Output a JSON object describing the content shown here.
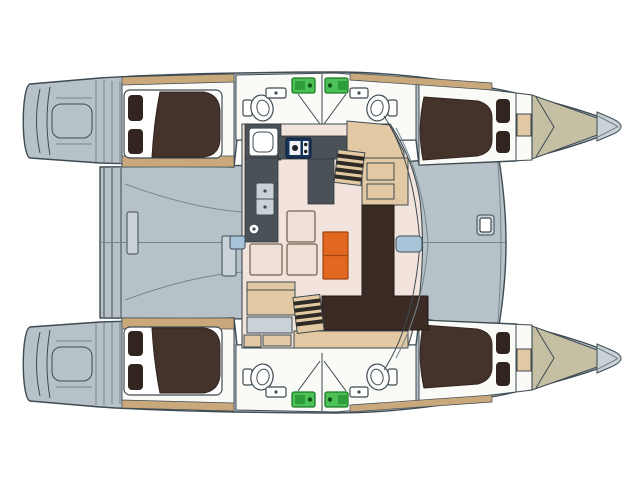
{
  "canvas": {
    "width": 640,
    "height": 480,
    "background": "#ffffff"
  },
  "diagram": {
    "type": "deck-plan",
    "subject": "catamaran interior layout, top view, bows pointing right",
    "rooms": [
      "port aft cabin",
      "port forward cabin",
      "starboard aft cabin",
      "starboard forward cabin",
      "port heads x2",
      "starboard heads x2",
      "salon with galley and chart table",
      "aft cockpit deck",
      "foredeck",
      "forepeak lockers",
      "swim platforms",
      "bow tips"
    ],
    "furniture_icons": [
      "double-berth-with-pillows x4",
      "toilet x4",
      "washbasin x4",
      "galley-stove",
      "galley-sink",
      "double-sink-unit",
      "l-shaped-sofa",
      "orange-table",
      "chart-table-with-seat",
      "hull-staircase x2",
      "deck-locker x2",
      "foredeck-hatch",
      "escape-hatch-green x4",
      "floor-panel x3",
      "door-cushion-blue x2"
    ]
  },
  "colors": {
    "background": "#ffffff",
    "deck": "#b6c2c8",
    "deck_light": "#c9d2d6",
    "outline": "#3e4b52",
    "line": "#75848d",
    "hull_white": "#fafaf7",
    "white": "#ffffff",
    "wood_trim": "#c9a87c",
    "furniture_tan": "#e2c9a3",
    "salon_floor": "#f2e4dc",
    "floor_panel": "#eee0d6",
    "panel_border": "#8a7668",
    "bed": "#44332b",
    "bed_dark": "#32251f",
    "sofa": "#3a2b25",
    "sofa_dark": "#241a16",
    "khaki": "#c5bfa3",
    "charcoal": "#4a5257",
    "charcoal_dark": "#2f363b",
    "navy": "#16335a",
    "navy_dark": "#0b1e38",
    "orange": "#e2671f",
    "orange_dark": "#9c4410",
    "green": "#4cc156",
    "green_mid": "#2e9e3a",
    "green_dark": "#1e7a28",
    "blue_light": "#a9c3d9",
    "step_dark": "#2e2a26"
  }
}
